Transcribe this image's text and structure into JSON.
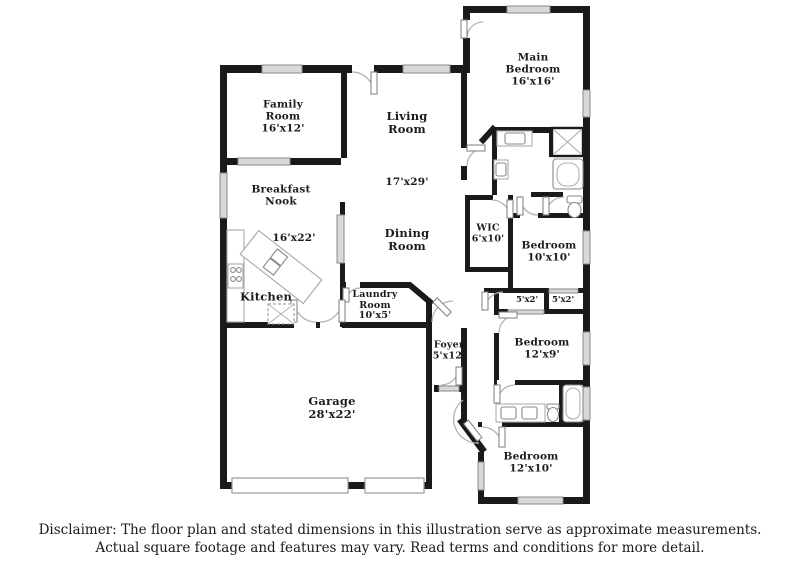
{
  "colors": {
    "wall": "#1a1a1a",
    "window": "#d8d8d8",
    "window_edge": "#8a8a8a",
    "door_arc": "#b3b3b3",
    "fixture": "#9a9a9a"
  },
  "rooms": {
    "family": "Family\nRoom\n16'x12'",
    "living": "Living\nRoom",
    "living_dims": "17'x29'",
    "breakfast": "Breakfast\nNook",
    "kitchen": "Kitchen",
    "kitchen_dims": "16'x22'",
    "dining": "Dining\nRoom",
    "laundry": "Laundry\nRoom\n10'x5'",
    "wic": "WIC\n6'x10'",
    "main_bedroom": "Main\nBedroom\n16'x16'",
    "bedroom_10x10": "Bedroom\n10'x10'",
    "closet_left": "5'x2'",
    "closet_right": "5'x2'",
    "bedroom_12x9": "Bedroom\n12'x9'",
    "foyer": "Foyer\n5'x12'",
    "bedroom_12x10": "Bedroom\n12'x10'",
    "garage": "Garage\n28'x22'"
  },
  "disclaimer": {
    "line1": "Disclaimer: The floor plan and stated dimensions in this illustration serve as approximate measurements.",
    "line2": "Actual square footage and features may vary. Read terms and conditions for more detail."
  }
}
